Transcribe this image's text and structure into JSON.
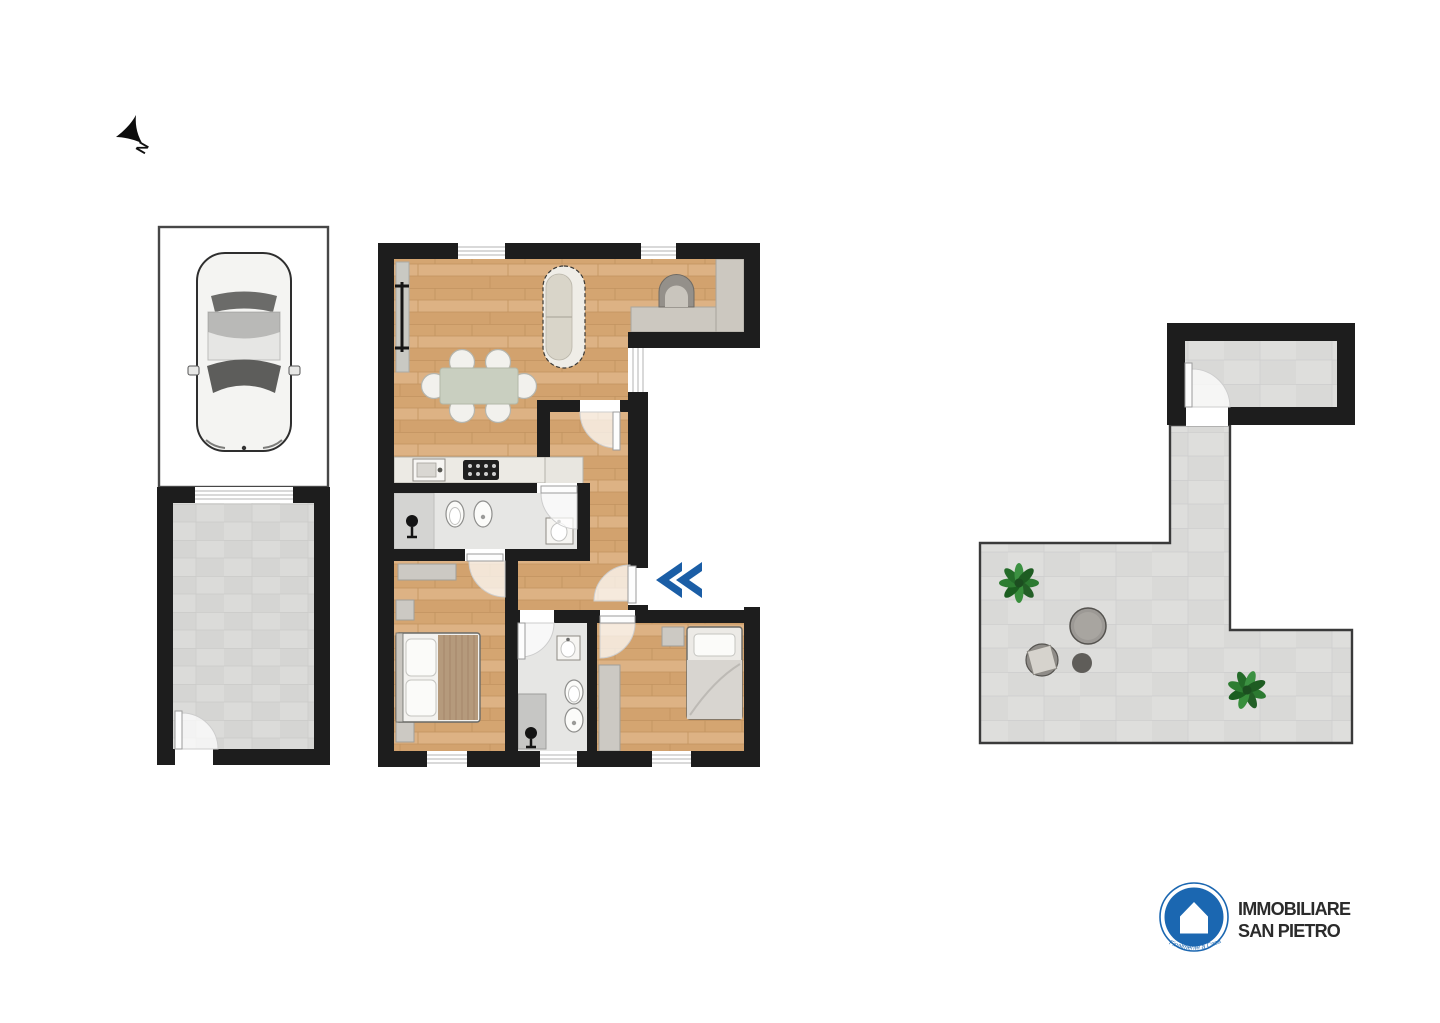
{
  "compass": {
    "label": "N"
  },
  "logo": {
    "line1": "IMMOBILIARE",
    "line2": "SAN PIETRO",
    "tagline": "Finalmente a Casa"
  },
  "colors": {
    "background": "#ffffff",
    "wall": "#1d1d1d",
    "wood": "#d9ac7a",
    "tile": "#dbdbd9",
    "terrace_tile": "#dededc",
    "bath_tile": "#e6e6e4",
    "counter": "#ccc8c0",
    "accent_blue": "#1b5ea6",
    "brand_blue": "#1b67b1",
    "text_dark": "#2b2b2b"
  },
  "fixtures": [
    "north-arrow",
    "parking-spot",
    "car",
    "garage",
    "garage-door",
    "sofa",
    "dining-table",
    "dining-chairs",
    "kitchen-counter",
    "kitchen-sink",
    "cooktop",
    "fireplace",
    "radiator",
    "double-bed",
    "single-bed",
    "nightstand",
    "wardrobe",
    "shower",
    "toilet",
    "bidet",
    "washbasin",
    "entrance-chevron",
    "door-swing",
    "window",
    "terrace-plant",
    "terrace-table",
    "terrace-stool",
    "brand-logo"
  ]
}
